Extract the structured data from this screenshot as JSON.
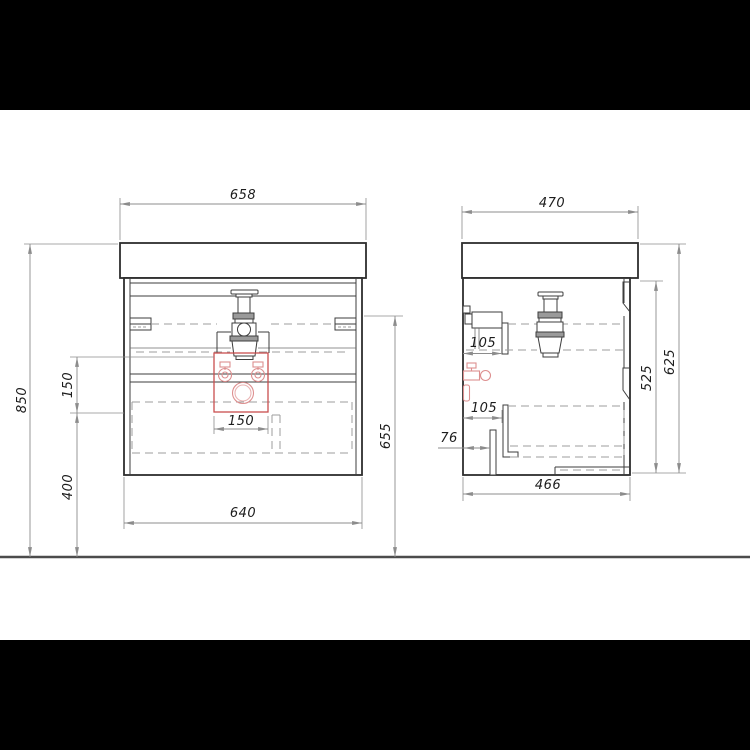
{
  "views": {
    "front": {
      "top_width": "658",
      "total_height": "850",
      "inlet_zone_height": "150",
      "under_clearance": "400",
      "cabinet_width": "640",
      "side_height": "655",
      "inlet_zone_width": "150"
    },
    "side": {
      "top_depth": "470",
      "slide_offset_upper": "105",
      "slide_offset_lower": "105",
      "bracket_offset": "76",
      "cabinet_depth": "466",
      "carcass_height": "525",
      "overall_height": "625"
    }
  },
  "colors": {
    "plumbing_accent": "#c94f4f",
    "main_line": "#2e2e2e",
    "dimension_line": "#8c8c8c",
    "letterbox": "#000000"
  }
}
